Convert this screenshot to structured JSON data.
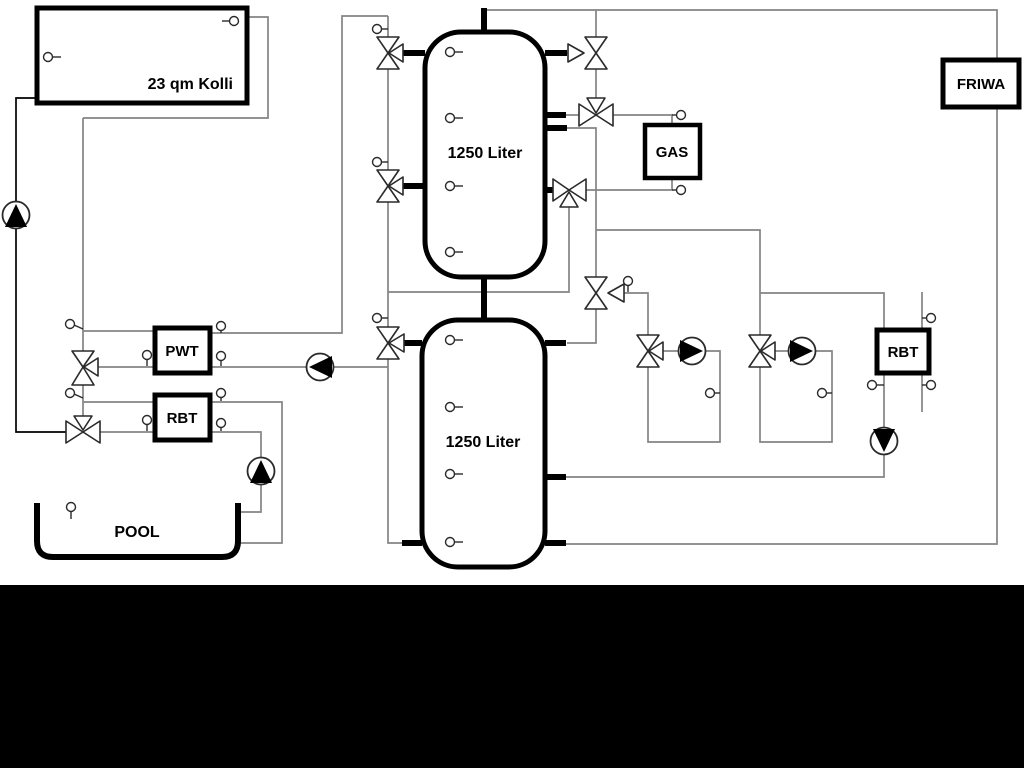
{
  "labels": {
    "collector": "23 qm Kolli",
    "tank1": "1250 Liter",
    "tank2": "1250 Liter",
    "pwt": "PWT",
    "rbt_left": "RBT",
    "rbt_right": "RBT",
    "gas": "GAS",
    "friwa": "FRIWA",
    "pool": "POOL"
  },
  "colors": {
    "background": "#ffffff",
    "pipe_gray": "#848484",
    "pipe_black": "#000000",
    "component_outline": "#2a2a2a",
    "bottom_bar": "#000000"
  },
  "components": {
    "tanks": [
      {
        "name": "buffer-tank-1",
        "label": "1250 Liter"
      },
      {
        "name": "buffer-tank-2",
        "label": "1250 Liter"
      }
    ],
    "boxes": [
      "23 qm Kolli",
      "PWT",
      "RBT",
      "GAS",
      "FRIWA",
      "RBT",
      "POOL"
    ],
    "pumps": [
      {
        "name": "solar-pump",
        "direction": "up"
      },
      {
        "name": "pwt-charge-pump",
        "direction": "left"
      },
      {
        "name": "heating-circuit-pump-1",
        "direction": "right"
      },
      {
        "name": "heating-circuit-pump-2",
        "direction": "right"
      },
      {
        "name": "rbt-right-pump",
        "direction": "down"
      },
      {
        "name": "pool-pump",
        "direction": "up"
      }
    ],
    "valves": [
      {
        "name": "valve-tank1-top-left",
        "type": "three-way"
      },
      {
        "name": "valve-tank1-mid-left",
        "type": "three-way"
      },
      {
        "name": "valve-tank2-left",
        "type": "three-way"
      },
      {
        "name": "valve-tank1-top-right",
        "type": "three-way"
      },
      {
        "name": "valve-gas-supply",
        "type": "three-way"
      },
      {
        "name": "valve-gas-return",
        "type": "three-way"
      },
      {
        "name": "valve-distribution",
        "type": "three-way"
      },
      {
        "name": "valve-circuit-1",
        "type": "three-way"
      },
      {
        "name": "valve-circuit-2",
        "type": "three-way"
      },
      {
        "name": "valve-pwt-mixing",
        "type": "three-way"
      },
      {
        "name": "valve-pool-mixing",
        "type": "three-way"
      }
    ],
    "sensor_count": 30
  }
}
